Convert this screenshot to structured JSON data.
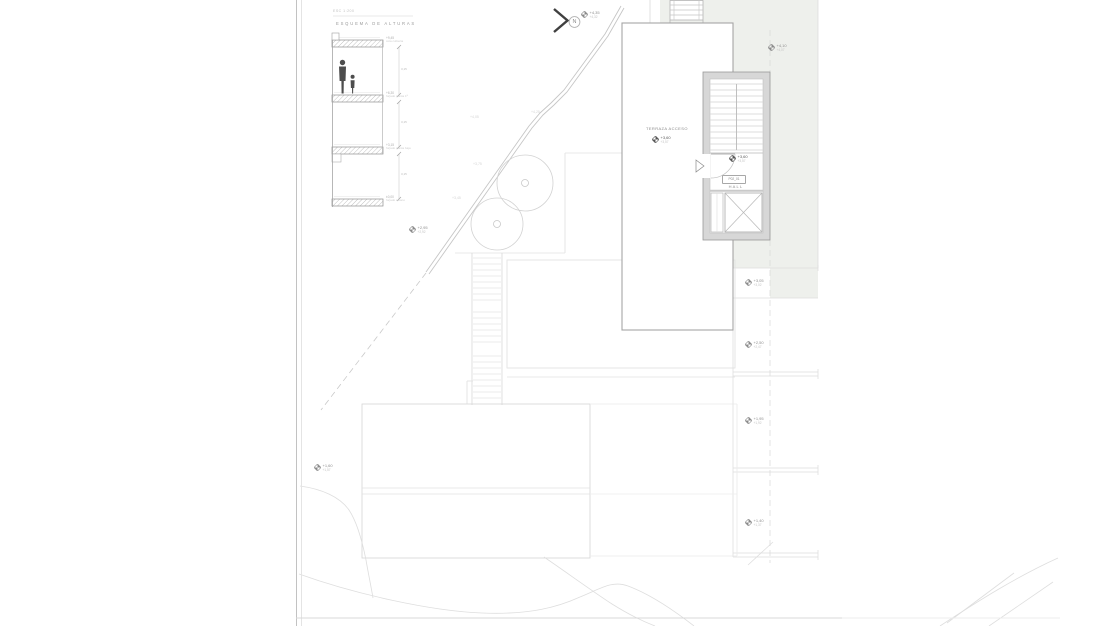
{
  "colors": {
    "green_area": "#eef0ec",
    "tower_wall": "#d7d7d7",
    "figure": "#4d4d4d"
  },
  "section": {
    "scale_label": "ESC 1:200",
    "title": "ESQUEMA DE ALTURAS",
    "levels": [
      {
        "label": "cota cubierta",
        "value": "+9,45"
      },
      {
        "label": "forjado planta 1ª",
        "value": "+6,30"
      },
      {
        "label": "forjado planta baja",
        "value": "+3,15"
      },
      {
        "label": "forjado sótano",
        "value": "±0,00"
      }
    ],
    "dims": [
      "3,15",
      "3,15",
      "3,15"
    ]
  },
  "north": {
    "label": "N"
  },
  "plan": {
    "terrace": {
      "label": "TERRAZA ACCESO",
      "level": "+3,60",
      "sublevel": "+3,57"
    },
    "hall": {
      "label": "HALL",
      "level": "+3,60",
      "sublevel": "+3,57",
      "door_tag": "P02_01"
    }
  },
  "site_markers": {
    "chevron": {
      "level": "+4,35",
      "sublevel": "+4,32"
    },
    "green": {
      "level": "+4,10",
      "sublevel": "+4,07"
    },
    "trees": {
      "level": "+2,95",
      "sublevel": "+2,92"
    },
    "left": {
      "level": "+1,60",
      "sublevel": "+1,57"
    },
    "r1": {
      "level": "+3,05",
      "sublevel": "+3,02"
    },
    "r2": {
      "level": "+2,50",
      "sublevel": "+2,47"
    },
    "r3": {
      "level": "+1,95",
      "sublevel": "+1,92"
    },
    "r4": {
      "level": "+1,40",
      "sublevel": "+1,37"
    }
  },
  "contour_labels": {
    "c1": "+4,25",
    "c2": "+4,05",
    "c3": "+3,75",
    "c4": "+3,45"
  }
}
